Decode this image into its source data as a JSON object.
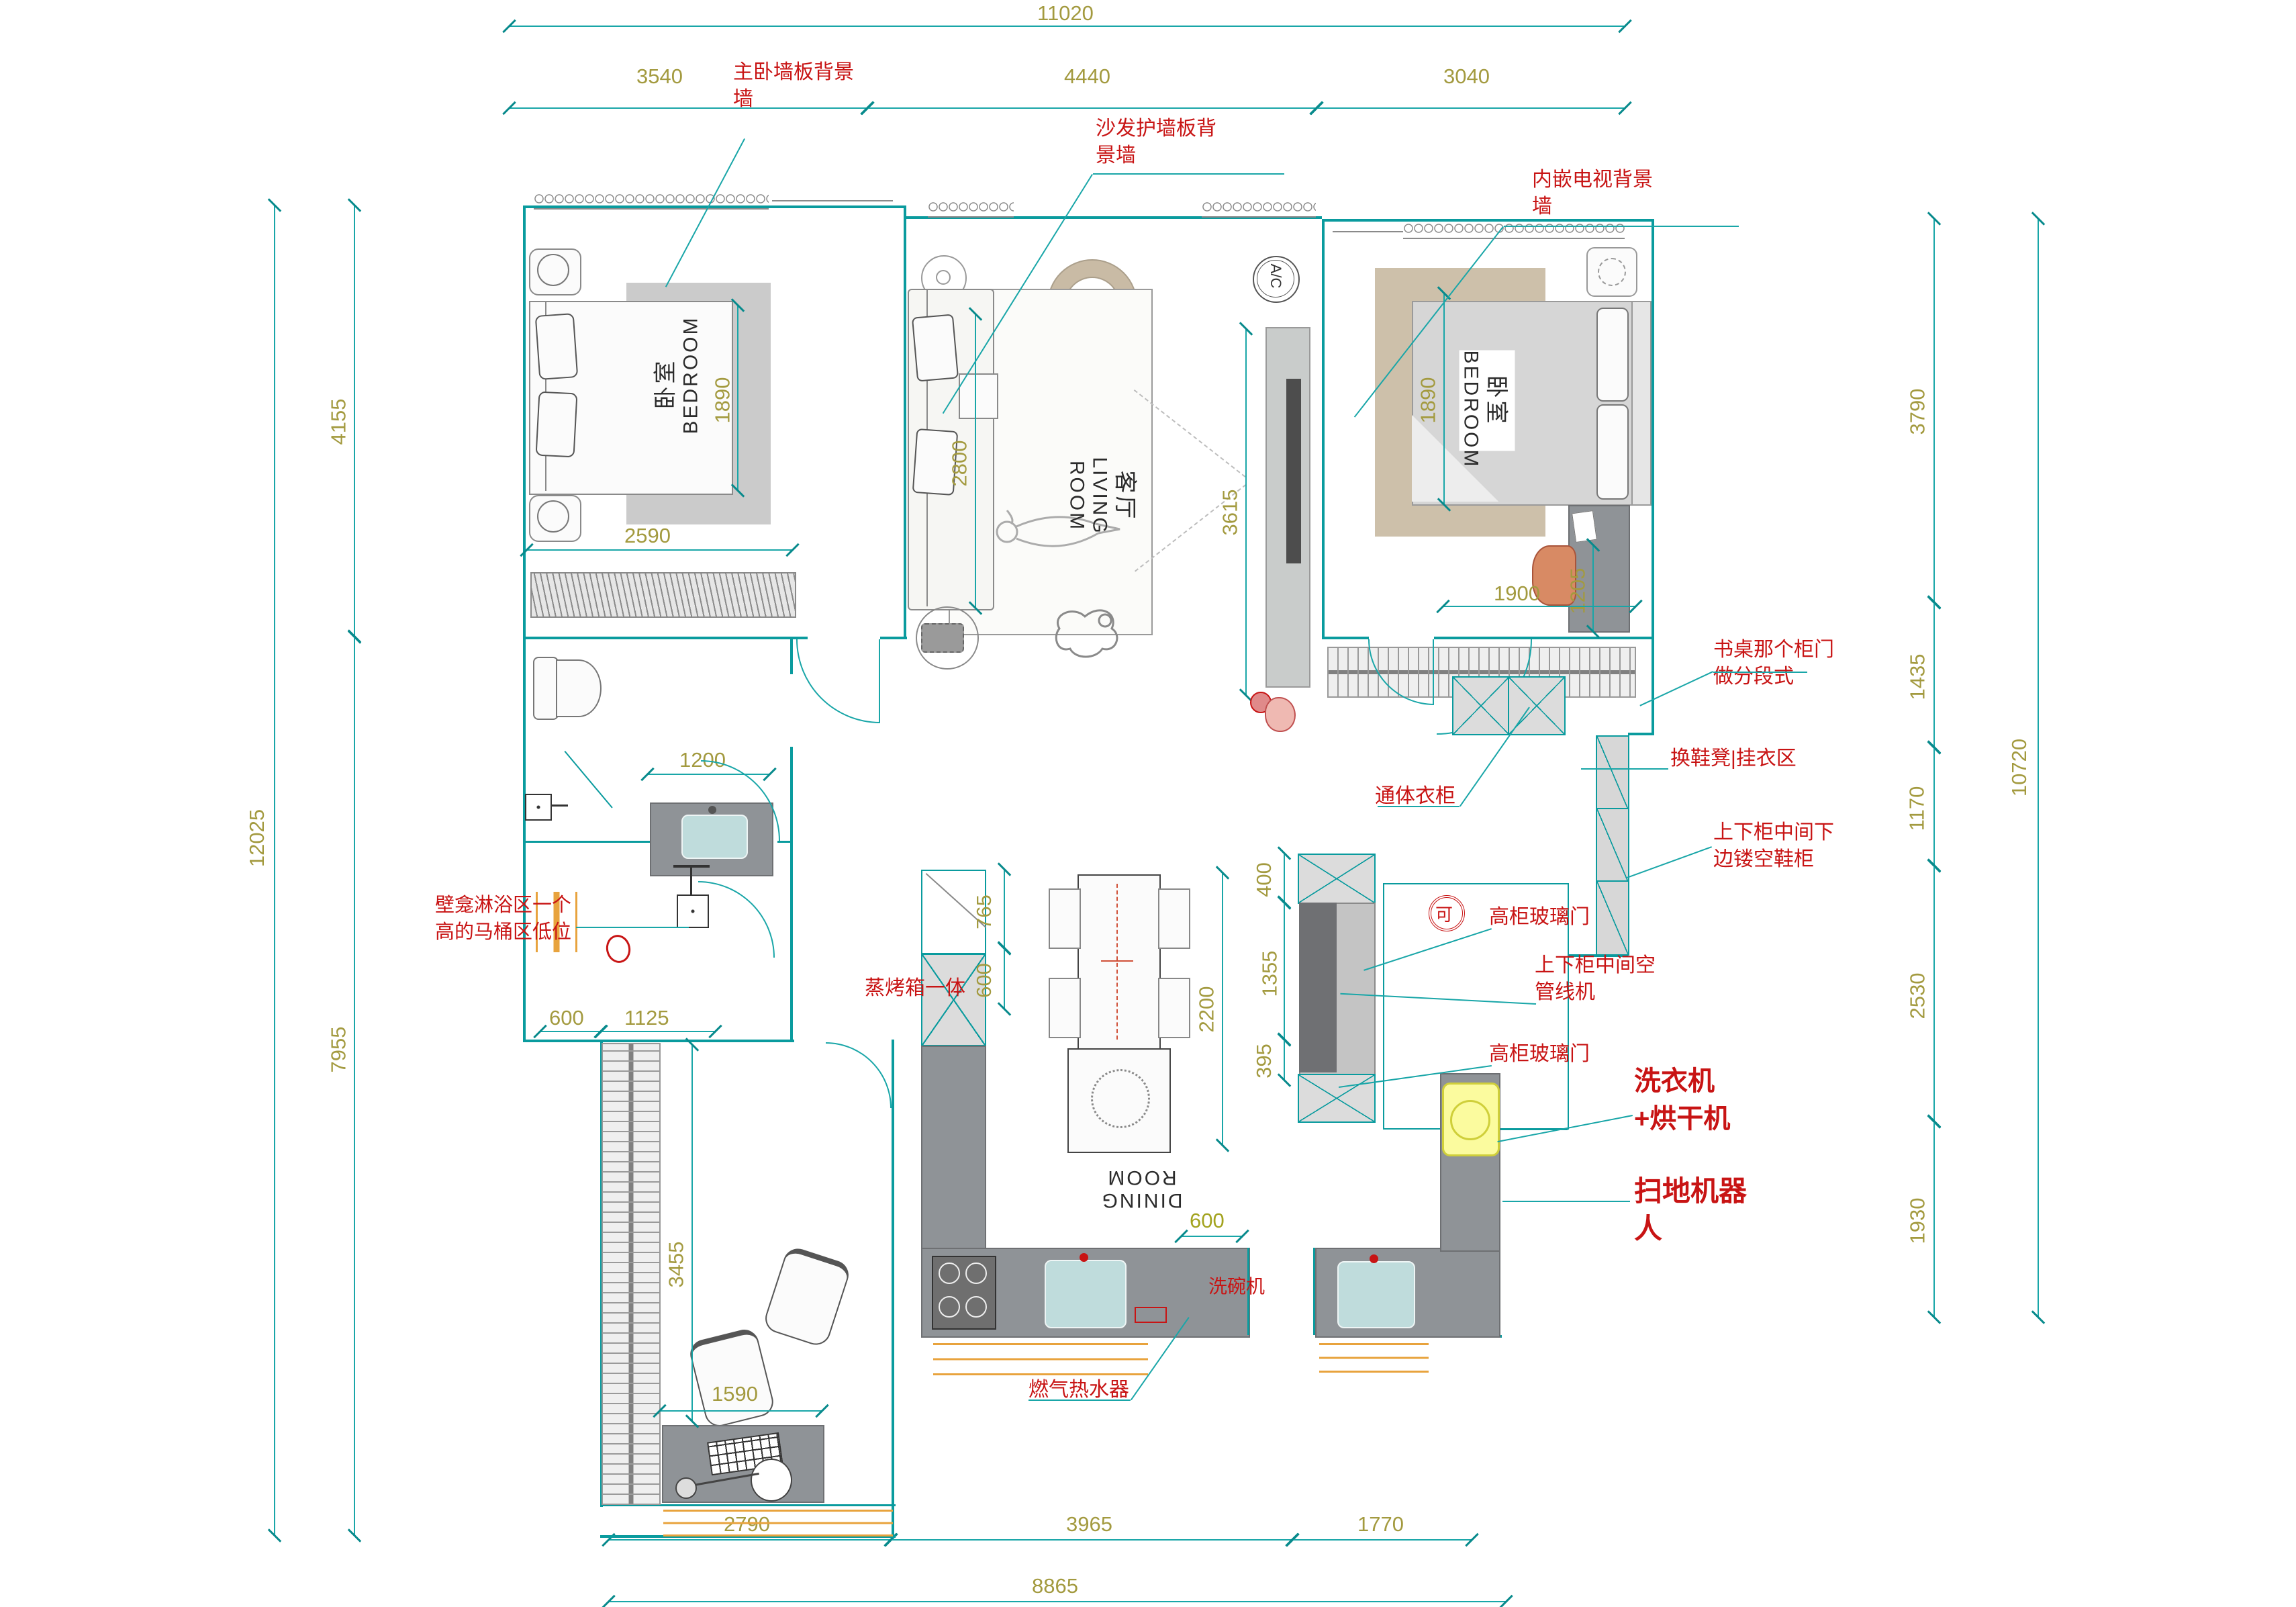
{
  "dims": {
    "d11020": "11020",
    "d3540": "3540",
    "d4440": "4440",
    "d3040": "3040",
    "d4155": "4155",
    "d12025": "12025",
    "d7955": "7955",
    "d3790": "3790",
    "d1435": "1435",
    "d1170": "1170",
    "d2530": "2530",
    "d1930": "1930",
    "d10720": "10720",
    "d2790": "2790",
    "d3965": "3965",
    "d1770": "1770",
    "d8865": "8865",
    "d2590": "2590",
    "d1890a": "1890",
    "d2800": "2800",
    "d3615": "3615",
    "d1890b": "1890",
    "d1900": "1900",
    "d1205": "1205",
    "d1200": "1200",
    "d600a": "600",
    "d1125": "1125",
    "d765": "765",
    "d600b": "600",
    "d2200": "2200",
    "d400": "400",
    "d1355": "1355",
    "d395": "395",
    "d600c": "600",
    "d3455": "3455",
    "d1590": "1590"
  },
  "labels": {
    "master_wall": "主卧墙板背景墙",
    "sofa_wall": "沙发护墙板背景墙",
    "tv_wall": "内嵌电视背景墙",
    "desk_cabinet": "书桌那个柜门做分段式",
    "bench": "换鞋凳|挂衣区",
    "shoe_cabinet": "上下柜中间下边镂空鞋柜",
    "wardrobe_full": "通体衣柜",
    "glass_door_top": "高柜玻璃门",
    "pipe_machine": "上下柜中间空管线机",
    "glass_door_bottom": "高柜玻璃门",
    "washer_dryer": "洗衣机+烘干机",
    "robot_vacuum": "扫地机器人",
    "dishwasher": "洗碗机",
    "steam_oven": "蒸烤箱一体",
    "gas_heater": "燃气热水器",
    "shower_niche": "壁龛淋浴区一个高的马桶区低位"
  },
  "rooms": {
    "master": {
      "zh": "卧室",
      "en": "BEDROOM"
    },
    "living": {
      "zh": "客厅",
      "en": "LIVING ROOM"
    },
    "bedroom2": {
      "zh": "卧室",
      "en": "BEDROOM"
    },
    "dining": {
      "en": "DINING ROOM"
    }
  },
  "symbols": {
    "ac": "A/C",
    "ok": "可"
  },
  "colors": {
    "wall_teal": "#0A9B9E",
    "dim_olive": "#A39A3F",
    "annotation_red": "#C81414",
    "counter_gray": "#8F9397",
    "washer_yellow": "#FBFB9E",
    "window_orange": "#E8A33D"
  }
}
